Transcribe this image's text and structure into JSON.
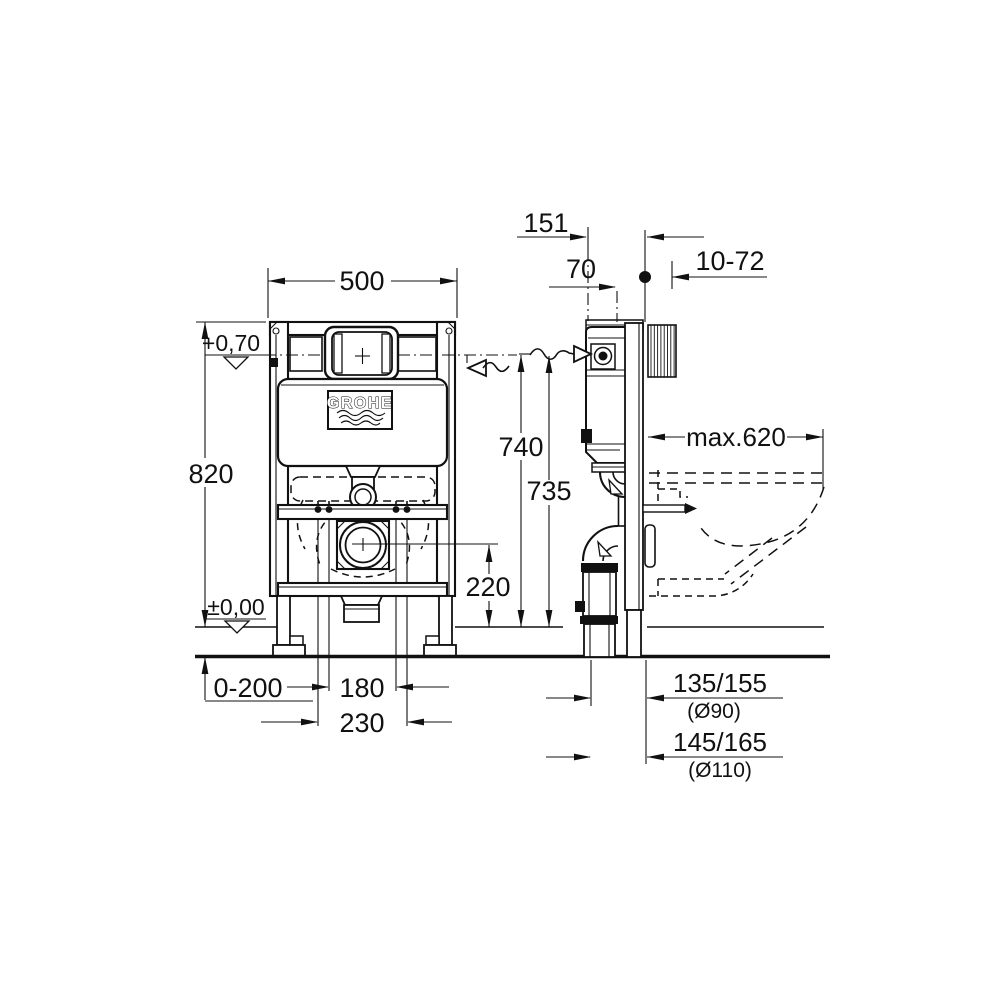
{
  "drawing": {
    "brand": {
      "logo": "GROHE"
    },
    "front": {
      "frame_width": "500",
      "frame_height": "820",
      "upper_level": "+0,70",
      "floor_level": "±0,00",
      "floor_adjust_range": "0-200",
      "bolt_spacing_inner": "180",
      "bolt_spacing_outer": "230",
      "outlet_center_height": "220",
      "flush_plate_height": "740",
      "water_inlet_height": "735"
    },
    "side": {
      "frame_depth": "151",
      "cistern_front_offset": "70",
      "wall_anchor_range": "10-72",
      "bowl_max_depth": "max.620",
      "drain_offset_90": "135/155",
      "drain_dia_90": "(Ø90)",
      "drain_offset_110": "145/165",
      "drain_dia_110": "(Ø110)"
    }
  }
}
